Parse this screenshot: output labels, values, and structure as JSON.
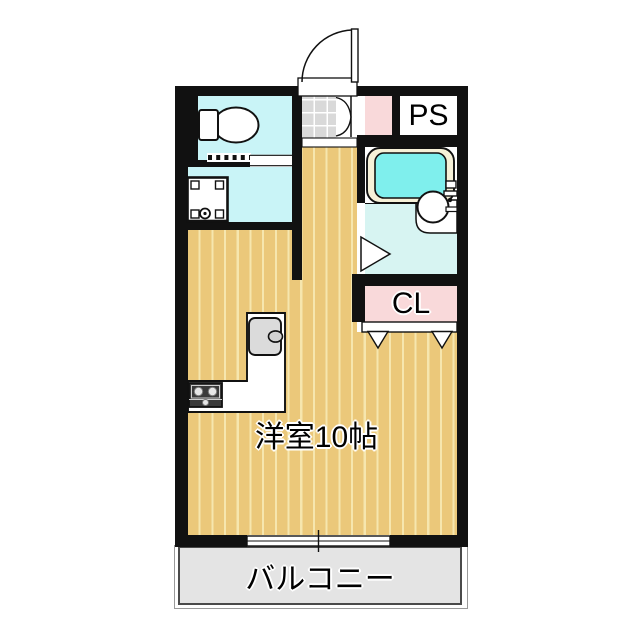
{
  "rooms": {
    "main_room": {
      "label": "洋室10帖"
    },
    "balcony": {
      "label": "バルコニー"
    },
    "pipe_space": {
      "label": "PS"
    },
    "closet": {
      "label": "CL"
    }
  },
  "colors": {
    "wall": "#111111",
    "floor": "#ebc87a",
    "floor_stripe": "#f6e6ae",
    "sanitary": "#c9f4f7",
    "bath_floor": "#d7f4f2",
    "tub_water": "#7fefed",
    "tub_rim": "#f6f1d8",
    "pink": "#f9d9da",
    "genkan": "#d9d9d9",
    "balcony": "#e4e4e4"
  },
  "fixtures": [
    "entrance-door",
    "shoe-closet-double-door",
    "genkan-tiles",
    "entrance-step",
    "toilet",
    "washing-machine-pan",
    "bathtub",
    "wash-basin",
    "bathroom-door",
    "closet-folding-door",
    "kitchen-counter",
    "kitchen-sink",
    "gas-stove",
    "sliding-window"
  ]
}
